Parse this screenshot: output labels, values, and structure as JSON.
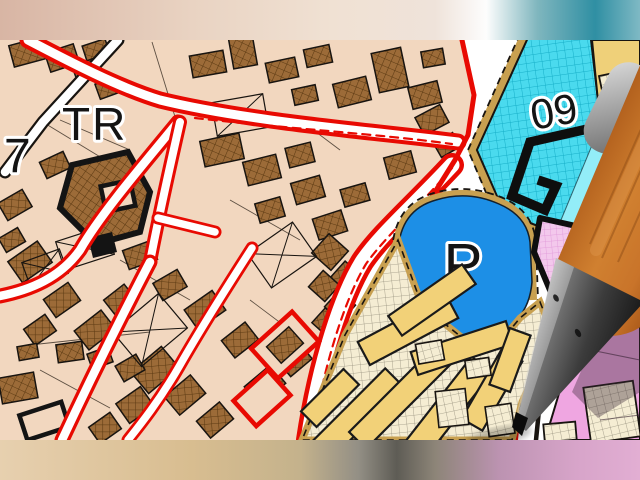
{
  "map": {
    "labels": {
      "district_number": "7",
      "district_tr": "TR",
      "zone_09": "09",
      "parking": "P",
      "parcel_measure": "25.3"
    },
    "colors": {
      "urban_bg": "#F2D7BF",
      "building_brown": "#9C6B38",
      "building_brown_line": "#5C3A12",
      "road_red": "#E80A02",
      "road_white": "#FFFFFF",
      "outline_black": "#181410",
      "zone_cyan": "#4ADAEE",
      "zone_cyan_light": "#93EDF8",
      "zone_blue": "#1D8FE6",
      "zone_yellow": "#F2D178",
      "zone_cream": "#F5EDD3",
      "zone_khaki_border": "#C8A050",
      "zone_pink": "#EFA6E1",
      "zone_pink_grid": "#F3C8EC",
      "pencil_wood": "#C06622",
      "pencil_metal_dark": "#3C3C3C",
      "pencil_clip_gray": "#B9B9B9"
    }
  }
}
